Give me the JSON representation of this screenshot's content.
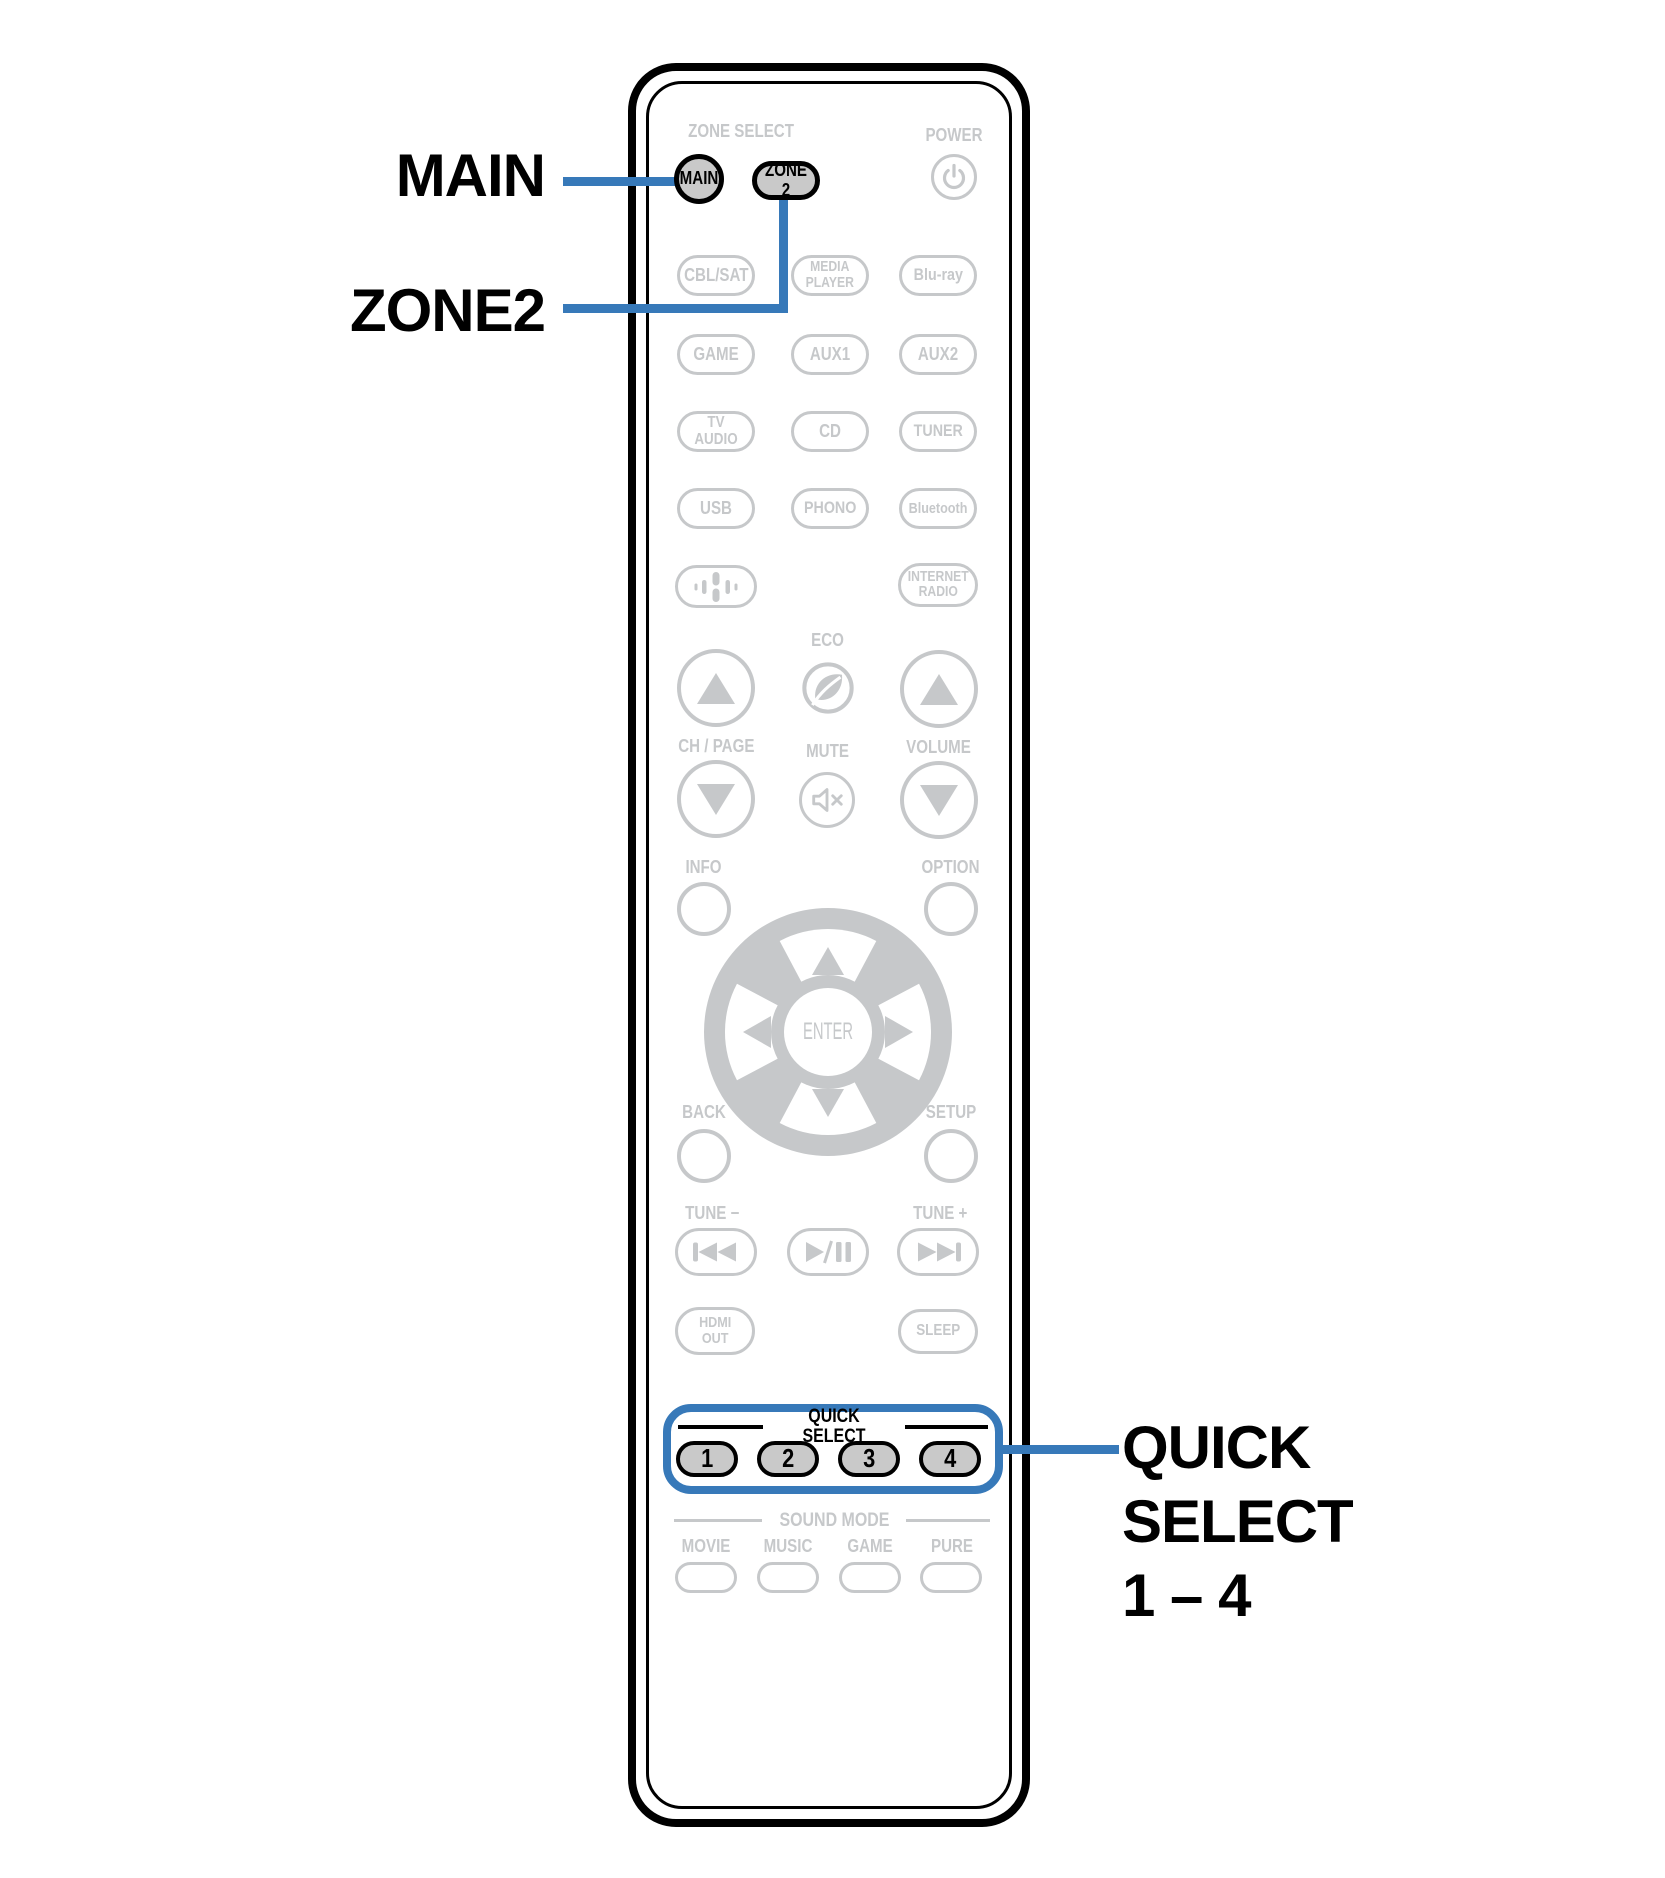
{
  "colors": {
    "accent": "#3779b9",
    "inactive": "#c6c8ca",
    "fill": "#c9c9c9"
  },
  "callouts": {
    "main": "MAIN",
    "zone2": "ZONE2",
    "quick_select": "QUICK\nSELECT\n1 – 4"
  },
  "remote": {
    "zone_select_header": "ZONE SELECT",
    "main_button": "MAIN",
    "zone2_button": "ZONE 2",
    "power_label": "POWER",
    "sources": [
      "CBL/SAT",
      "MEDIA\nPLAYER",
      "Blu-ray",
      "GAME",
      "AUX1",
      "AUX2",
      "TV AUDIO",
      "CD",
      "TUNER",
      "USB",
      "PHONO",
      "Bluetooth"
    ],
    "internet_radio_button": "INTERNET\nRADIO",
    "eco_label": "ECO",
    "ch_page_label": "CH / PAGE",
    "mute_label": "MUTE",
    "volume_label": "VOLUME",
    "info_label": "INFO",
    "option_label": "OPTION",
    "enter_label": "ENTER",
    "back_label": "BACK",
    "setup_label": "SETUP",
    "tune_minus_label": "TUNE −",
    "tune_plus_label": "TUNE +",
    "hdmi_out_button": "HDMI\nOUT",
    "sleep_button": "SLEEP",
    "quick_select": {
      "header": "QUICK SELECT",
      "buttons": [
        "1",
        "2",
        "3",
        "4"
      ]
    },
    "sound_mode": {
      "header": "SOUND MODE",
      "modes": [
        "MOVIE",
        "MUSIC",
        "GAME",
        "PURE"
      ]
    }
  },
  "icons": [
    "power-icon",
    "audio-wave-icon",
    "eco-leaf-icon",
    "mute-icon",
    "up-arrow-icon",
    "down-arrow-icon",
    "dpad-up-icon",
    "dpad-down-icon",
    "dpad-left-icon",
    "dpad-right-icon",
    "skip-back-icon",
    "play-pause-icon",
    "skip-forward-icon"
  ]
}
